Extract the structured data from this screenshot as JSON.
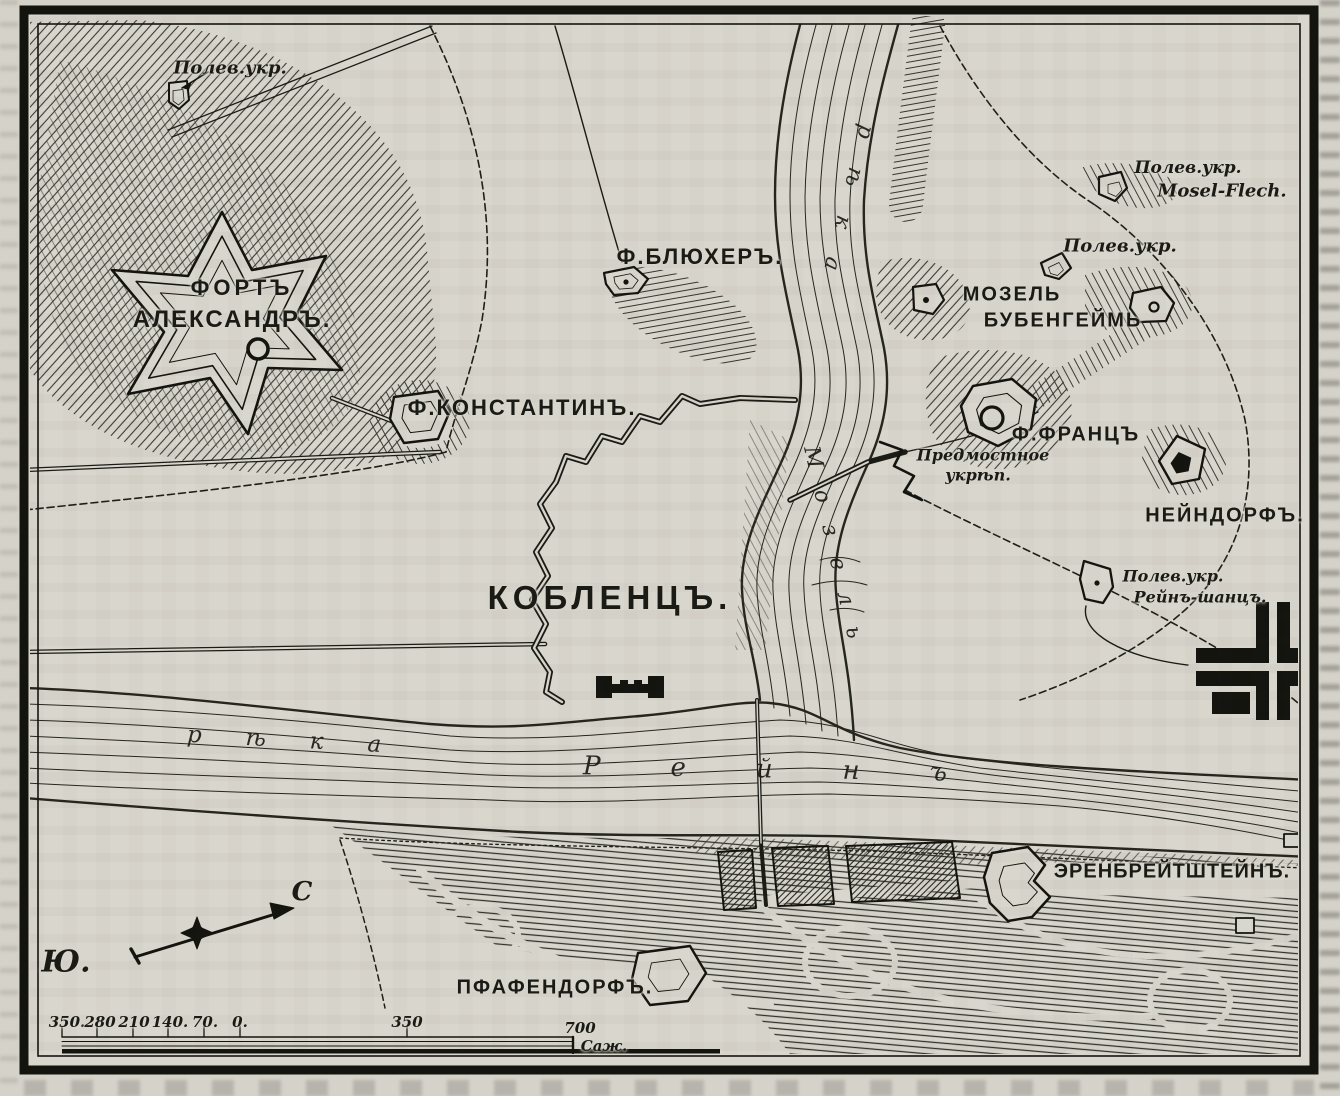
{
  "colors": {
    "paper": "#d9d6cd",
    "ink": "#1b1b16"
  },
  "labels": {
    "fieldwork_nw": "Полев.укр.",
    "fort_alexander_line1": "ФОРТЪ",
    "fort_alexander_line2": "АЛЕКСАНДРЪ.",
    "fort_blucher": "Ф.БЛЮХЕРЪ.",
    "fort_konstantin": "Ф.КОНСТАНТИНЪ.",
    "koblenz": "КОБЛЕНЦЪ.",
    "fieldwork_mosel_flech_line1": "Полев.укр.",
    "fieldwork_mosel_flech_line2": "Mosel-Flech.",
    "fieldwork_center": "Полев.укр.",
    "mosel_bubenheim_line1": "МОЗЕЛЬ",
    "mosel_bubenheim_line2": "БУБЕНГЕЙМЬ",
    "fort_franz": "Ф.ФРАНЦЪ",
    "bridgehead_line1": "Предмостное",
    "bridgehead_line2": "укрѣп.",
    "neindorf": "НЕЙНДОРФЪ.",
    "fieldwork_rhine_line1": "Полев.укр.",
    "fieldwork_rhine_line2": "Рейнъ-шанцъ.",
    "ehrenbreitstein": "ЭРЕНБРЕЙТШТЕЙНЪ.",
    "pfaffendorf": "ПФАФЕНДОРФЪ."
  },
  "rivers": {
    "rhine_word1": "рѣка",
    "rhine_word2": "Рейнъ",
    "mosel_word1": "рѣка",
    "mosel_word2": "Мозель"
  },
  "compass": {
    "south": "Ю.",
    "north": "С"
  },
  "scale_bar": {
    "left_ticks": [
      "350.",
      "280",
      "210",
      "140.",
      "70.",
      "0."
    ],
    "mid_tick": "350",
    "end_tick": "700",
    "unit": "Саж."
  }
}
